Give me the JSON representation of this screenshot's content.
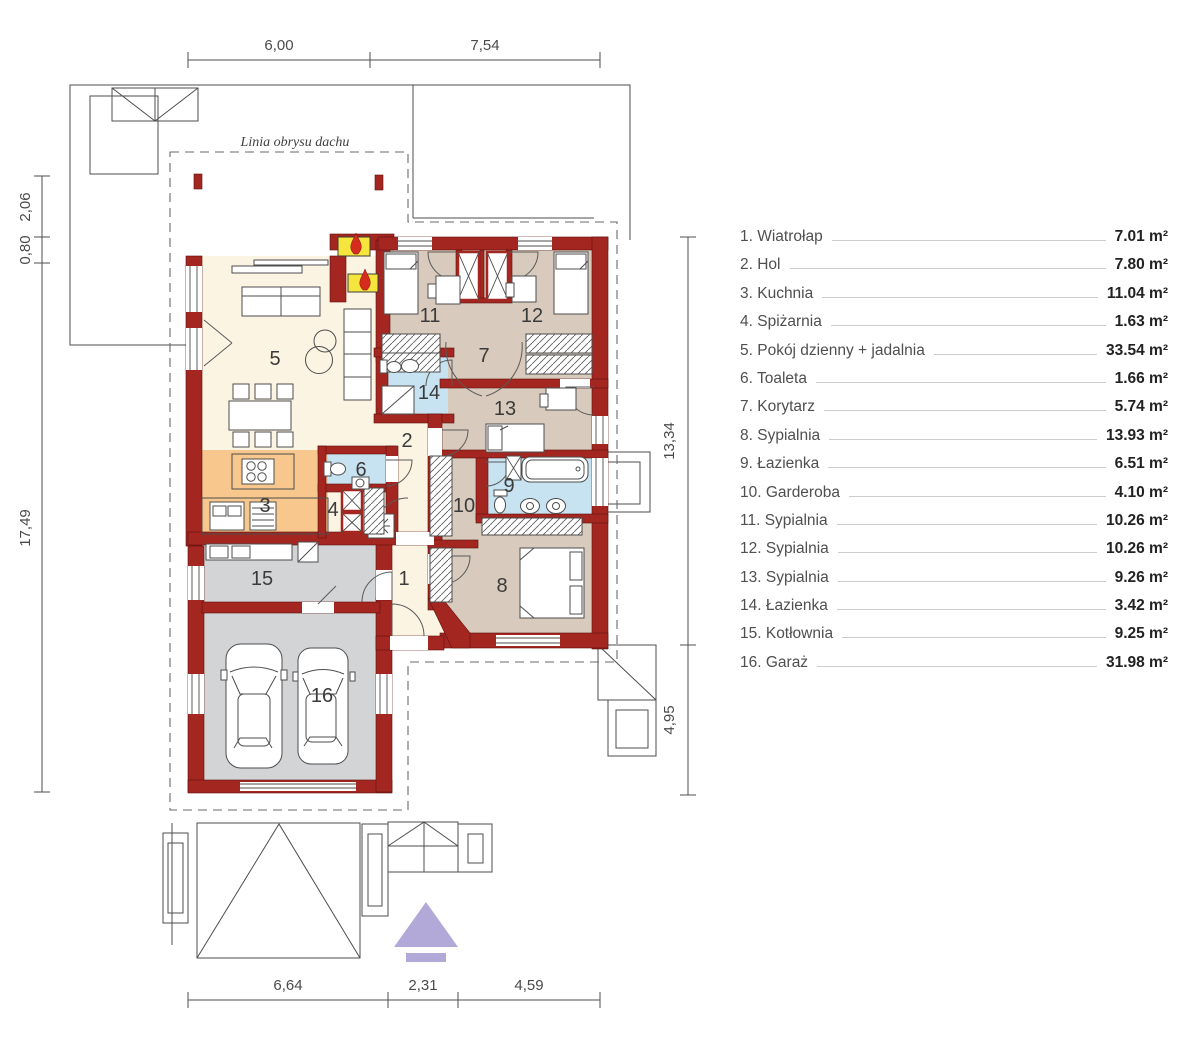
{
  "plan": {
    "roof_label": "Linia obrysu dachu",
    "dimensions": {
      "top": [
        "6,00",
        "7,54"
      ],
      "left": [
        "2,06",
        "0,80",
        "17,49"
      ],
      "right": [
        "13,34",
        "4,95"
      ],
      "bottom": [
        "6,64",
        "2,31",
        "4,59"
      ]
    },
    "colors": {
      "wall_red": "#A32621",
      "living_cream": "#FBF4E3",
      "bedroom_tan": "#D8CABC",
      "bath_blue": "#C7E3F2",
      "kitchen_orange": "#F7C78D",
      "utility_gray": "#D3D4D6",
      "fireplace_yellow": "#F6E53C",
      "flame_red": "#D62C1E",
      "entrance_arrow_lavender": "#B2A9D8"
    }
  },
  "rooms": [
    {
      "num": "1",
      "name": "Wiatrołap",
      "legend": "1. Wiatrołap",
      "area": "7.01 m²"
    },
    {
      "num": "2",
      "name": "Hol",
      "legend": "2. Hol",
      "area": "7.80 m²"
    },
    {
      "num": "3",
      "name": "Kuchnia",
      "legend": "3. Kuchnia",
      "area": "11.04 m²"
    },
    {
      "num": "4",
      "name": "Spiżarnia",
      "legend": "4. Spiżarnia",
      "area": "1.63 m²"
    },
    {
      "num": "5",
      "name": "Pokój dzienny + jadalnia",
      "legend": "5. Pokój dzienny + jadalnia",
      "area": "33.54 m²"
    },
    {
      "num": "6",
      "name": "Toaleta",
      "legend": "6. Toaleta",
      "area": "1.66 m²"
    },
    {
      "num": "7",
      "name": "Korytarz",
      "legend": "7. Korytarz",
      "area": "5.74 m²"
    },
    {
      "num": "8",
      "name": "Sypialnia",
      "legend": "8. Sypialnia",
      "area": "13.93 m²"
    },
    {
      "num": "9",
      "name": "Łazienka",
      "legend": "9. Łazienka",
      "area": "6.51 m²"
    },
    {
      "num": "10",
      "name": "Garderoba",
      "legend": "10. Garderoba",
      "area": "4.10 m²"
    },
    {
      "num": "11",
      "name": "Sypialnia",
      "legend": "11. Sypialnia",
      "area": "10.26 m²"
    },
    {
      "num": "12",
      "name": "Sypialnia",
      "legend": "12. Sypialnia",
      "area": "10.26 m²"
    },
    {
      "num": "13",
      "name": "Sypialnia",
      "legend": "13. Sypialnia",
      "area": "9.26 m²"
    },
    {
      "num": "14",
      "name": "Łazienka",
      "legend": "14. Łazienka",
      "area": "3.42 m²"
    },
    {
      "num": "15",
      "name": "Kotłownia",
      "legend": "15. Kotłownia",
      "area": "9.25 m²"
    },
    {
      "num": "16",
      "name": "Garaż",
      "legend": "16. Garaż",
      "area": "31.98 m²"
    }
  ]
}
